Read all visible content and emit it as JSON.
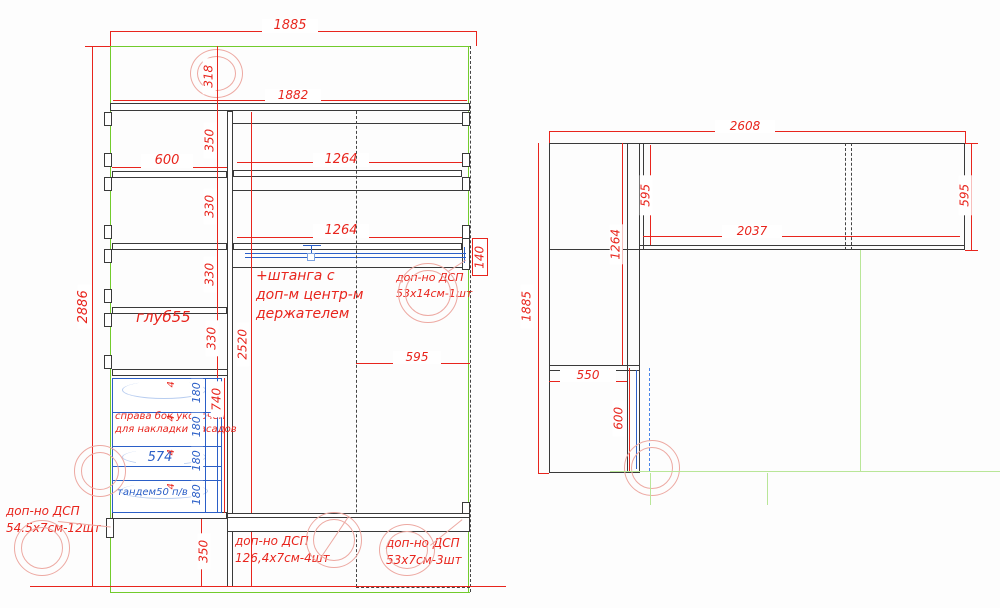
{
  "title": "wardrobe-cad-drawing",
  "colors": {
    "dimension": "#e8251d",
    "structure": "#3a3a3a",
    "hardware": "#2b5fc7",
    "room_outline": "#72cb2c",
    "wall_guide": "#b9e698",
    "marker": "#eda9a2"
  },
  "lv": {
    "w1885": "1885",
    "h2886": "2886",
    "g318": "318",
    "w1882": "1882",
    "d350": "350",
    "c600": "600",
    "d330": [
      "330",
      "330",
      "330"
    ],
    "d1264": [
      "1264",
      "1264"
    ],
    "d140": "140",
    "rod_note": [
      "+штанга с",
      "доп-м центр-м",
      "держателем"
    ],
    "dsp_rod": [
      "доп-но ДСП",
      "53х14см-1шт"
    ],
    "depth": "глуб55",
    "h2520": "2520",
    "w595": "595",
    "fasad_note": [
      "справа бок укорочен",
      "для накладки фасадов"
    ],
    "w574": "574",
    "g4": [
      "4",
      "4",
      "4",
      "4"
    ],
    "d180": [
      "180",
      "180",
      "180",
      "180"
    ],
    "d740": "740",
    "tandem": "тандем50 п/в",
    "d350b": "350",
    "dsp_left": [
      "доп-но ДСП",
      "54.5х7см-12шт"
    ],
    "dsp_mid": [
      "доп-но ДСП",
      "126,4х7см-4шт"
    ],
    "dsp_right": [
      "доп-но ДСП",
      "53х7см-3шт"
    ]
  },
  "rv": {
    "w2608": "2608",
    "d595l": "595",
    "d595r": "595",
    "w2037": "2037",
    "h1264": "1264",
    "h1885": "1885",
    "w550": "550",
    "h600": "600"
  }
}
